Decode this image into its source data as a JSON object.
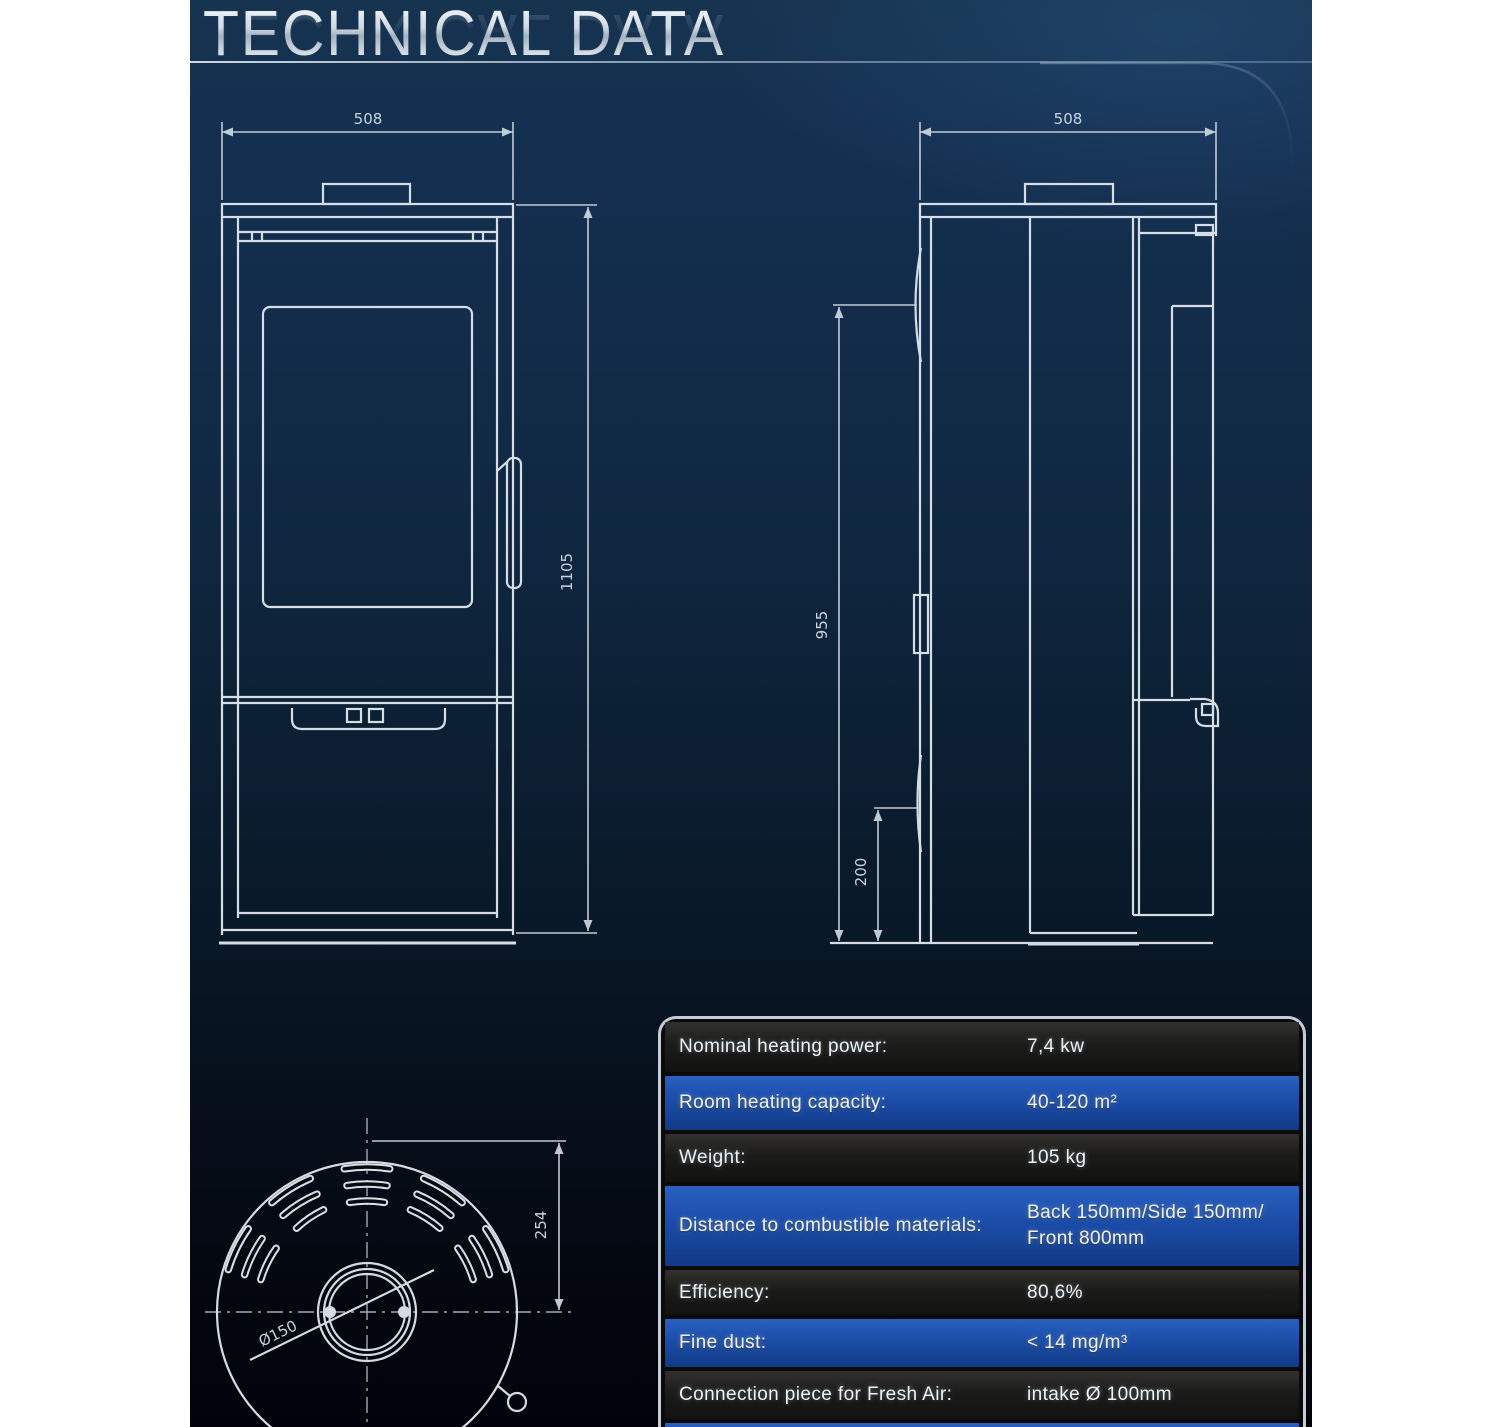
{
  "title": "TECHNICAL DATA",
  "drawing": {
    "front": {
      "width": "508",
      "height": "1105"
    },
    "side": {
      "width": "508",
      "height": "955",
      "plinth": "200"
    },
    "top": {
      "depth": "254",
      "flue": "Ø150"
    }
  },
  "table": {
    "rows": [
      {
        "label": "Nominal heating power:",
        "value": "7,4 kw"
      },
      {
        "label": "Room heating capacity:",
        "value": "40-120 m²"
      },
      {
        "label": "Weight:",
        "value": "105 kg"
      },
      {
        "label": "Distance to combustible materials:",
        "value": "Back 150mm/Side 150mm/",
        "value2": "Front 800mm"
      },
      {
        "label": "Efficiency:",
        "value": "80,6%"
      },
      {
        "label": "Fine dust:",
        "value": "< 14 mg/m³"
      },
      {
        "label": "Connection piece for Fresh Air:",
        "value": "intake Ø 100mm"
      }
    ]
  },
  "colors": {
    "panel_top": "#16334f",
    "panel_bottom": "#02030a",
    "row_blue": "#1b4da8",
    "row_dark": "#1b1b19",
    "line": "#e2e9f0",
    "dim_text": "#c9d3dd"
  }
}
